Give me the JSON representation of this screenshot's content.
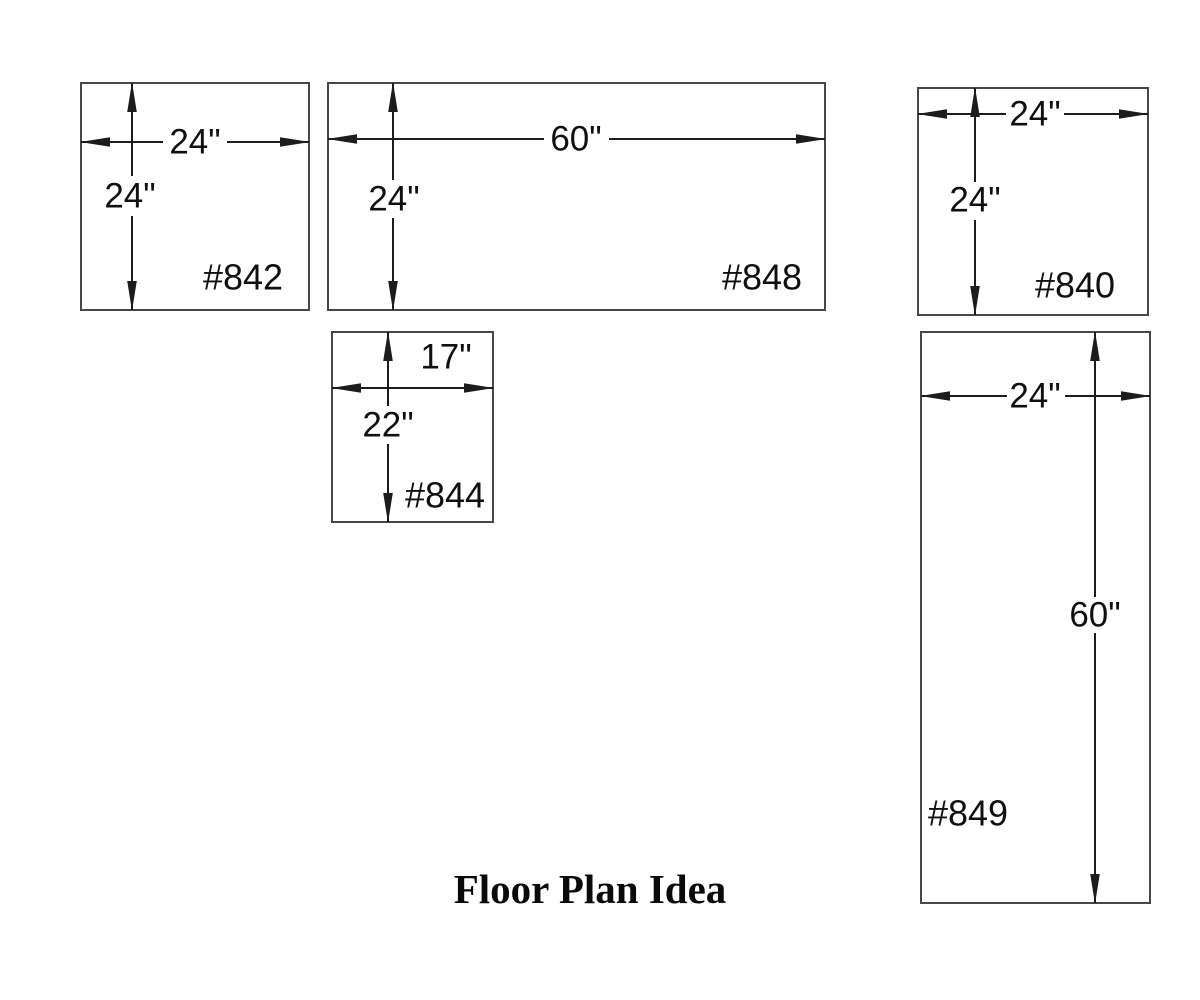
{
  "title": "Floor Plan Idea",
  "colors": {
    "box_stroke": "#474747",
    "dimension_ink": "#1c1c1c",
    "text": "#101010",
    "background": "#ffffff"
  },
  "cabinets": [
    {
      "id": "#842",
      "width": "24\"",
      "height": "24\""
    },
    {
      "id": "#848",
      "width": "60\"",
      "height": "24\""
    },
    {
      "id": "#840",
      "width": "24\"",
      "height": "24\""
    },
    {
      "id": "#844",
      "width": "17\"",
      "height": "22\""
    },
    {
      "id": "#849",
      "width": "24\"",
      "height": "60\""
    }
  ]
}
